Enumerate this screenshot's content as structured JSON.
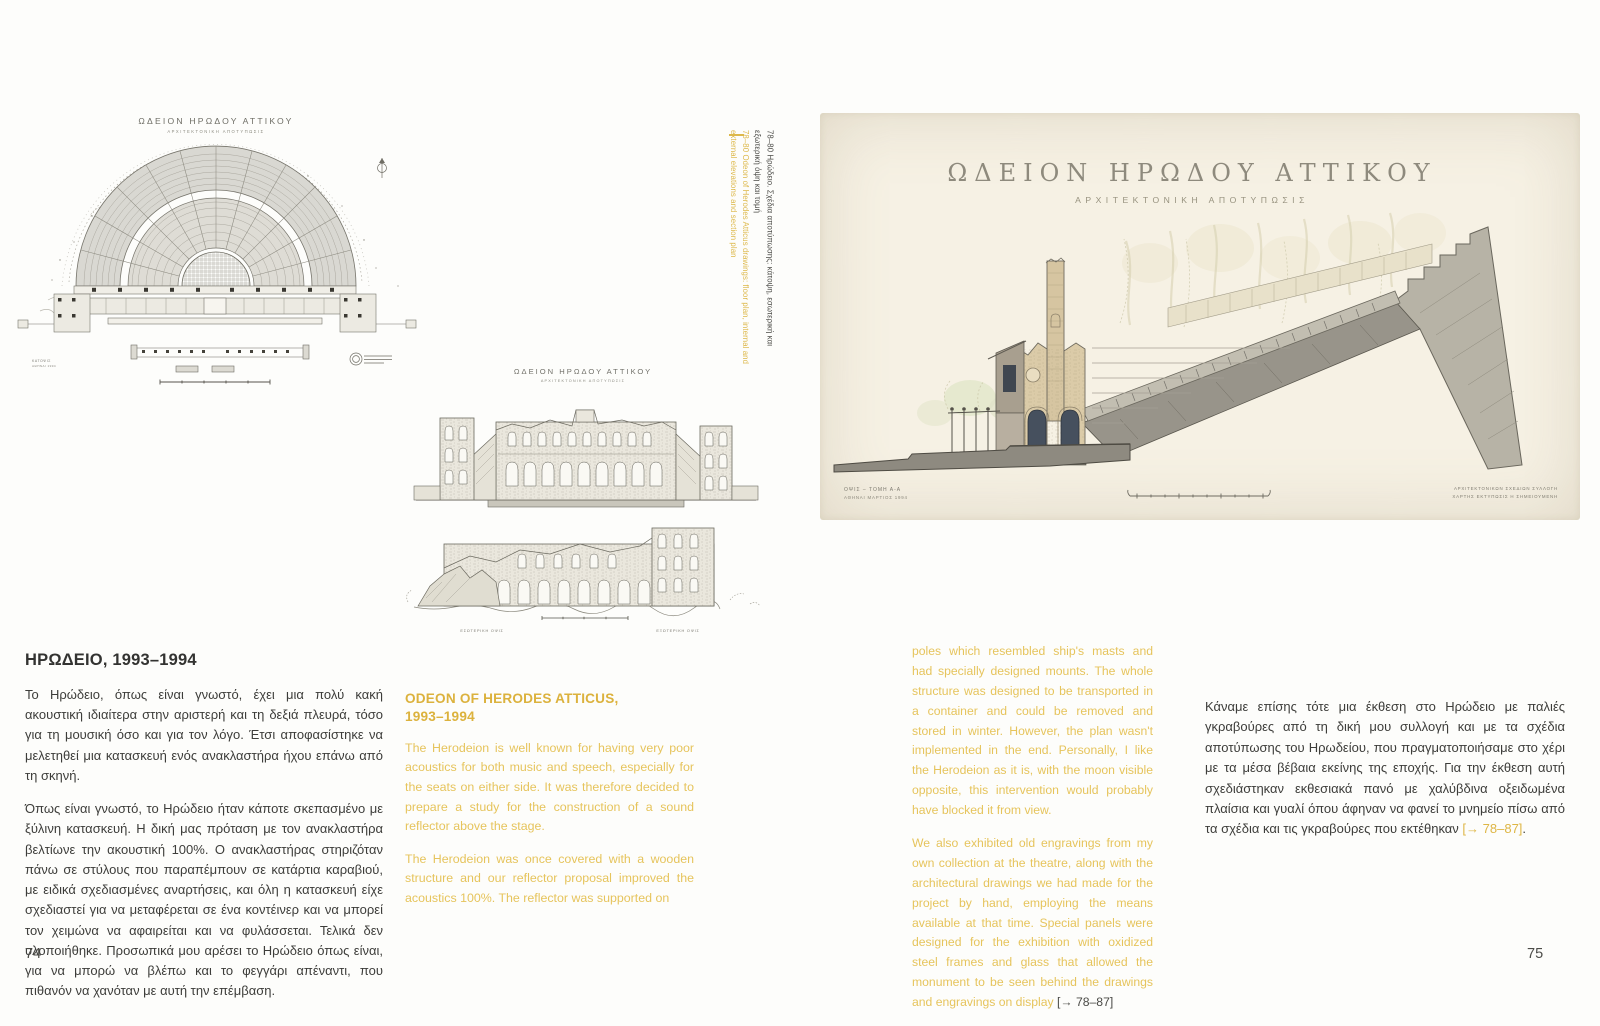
{
  "colors": {
    "accent_yellow": "#e2bd4a",
    "heading_yellow": "#dcb23d",
    "text_dark": "#3d3d3a",
    "paper_cream": "#f6f1e4"
  },
  "page_left": {
    "page_number": "74",
    "plan_drawing": {
      "title": "ΩΔΕΙΟΝ ΗΡΩΔΟΥ ΑΤΤΙΚΟΥ",
      "subtitle": "ΑΡΧΙΤΕΚΤΟΝΙΚΗ ΑΠΟΤΥΠΩΣΙΣ",
      "corner_note_1": "ΚΑΤΟΨΙΣ",
      "corner_note_2": "ΑΘΗΝΑΙ 1994"
    },
    "elevation_drawing": {
      "title": "ΩΔΕΙΟΝ ΗΡΩΔΟΥ ΑΤΤΙΚΟΥ",
      "subtitle": "ΑΡΧΙΤΕΚΤΟΝΙΚΗ ΑΠΟΤΥΠΩΣΙΣ",
      "label_left": "ΕΣΩΤΕΡΙΚΗ ΟΨΙΣ",
      "label_right": "ΕΞΩΤΕΡΙΚΗ ΟΨΙΣ"
    },
    "vertical_caption": {
      "greek": "78–80 Ηρώδειο. Σχέδια αποτύπωσης: κάτοψη, εσωτερική και εξωτερική όψη και τομή",
      "english": "78–80 Odeon of Herodes Atticus drawings: floor plan, internal and external elevations and section plan"
    },
    "greek_section": {
      "heading": "ΗΡΩΔΕΙΟ, 1993–1994",
      "paragraphs": [
        "Το Ηρώδειο, όπως είναι γνωστό, έχει μια πολύ κακή ακουστική ιδιαίτερα στην αριστερή και τη δεξιά πλευρά, τόσο για τη μουσική όσο και για τον λόγο. Έτσι αποφασίστηκε να μελετηθεί μια κατασκευή ενός ανακλαστήρα ήχου επάνω από τη σκηνή.",
        "Όπως είναι γνωστό, το Ηρώδειο ήταν κάποτε σκεπασμένο με ξύλινη κατασκευή. Η δική μας πρόταση με τον ανακλαστήρα βελτίωνε την ακουστική 100%. Ο ανακλαστήρας στηριζόταν πάνω σε στύλους που παραπέμπουν σε κατάρτια καραβιού, με ειδικά σχεδιασμένες αναρτήσεις, και όλη η κατασκευή είχε σχεδιαστεί για να μεταφέρεται σε ένα κοντέινερ και να μπορεί τον χειμώνα να αφαιρείται και να φυλάσσεται. Τελικά δεν υλοποιήθηκε. Προσωπικά μου αρέσει το Ηρώδειο όπως είναι, για να μπορώ να βλέπω και το φεγγάρι απέναντι, που πιθανόν να χανόταν με αυτή την επέμβαση."
      ]
    },
    "english_section": {
      "heading_line1": "ODEON OF HERODES ATTICUS,",
      "heading_line2": "1993–1994",
      "paragraphs": [
        "The Herodeion is well known for having very poor acoustics for both music and speech, especially for the seats on either side. It was therefore decided to prepare a study for the construction of a sound reflector above the stage.",
        "The Herodeion was once covered with a wooden structure and our reflector proposal improved the acoustics 100%. The reflector was supported on"
      ]
    }
  },
  "page_right": {
    "page_number": "75",
    "section_drawing": {
      "title": "ΩΔΕΙΟΝ ΗΡΩΔΟΥ ΑΤΤΙΚΟΥ",
      "subtitle": "ΑΡΧΙΤΕΚΤΟΝΙΚΗ ΑΠΟΤΥΠΩΣΙΣ",
      "caption_left_line1": "ΟΨΙΣ – ΤΟΜΗ Α-Α",
      "caption_left_line2": "ΑΘΗΝΑΙ ΜΑΡΤΙΟΣ 1994",
      "caption_right_line1": "ΑΡΧΙΤΕΚΤΟΝΙΚΩΝ ΣΧΕΔΙΩΝ ΣΥΛΛΟΓΗ",
      "caption_right_line2": "ΧΑΡΤΗΣ ΕΚΤΥΠΩΣΙΣ Η ΣΗΜΕΙΟΥΜΕΝΗ"
    },
    "english_column": {
      "paragraph1": "poles which resembled ship's masts and had specially designed mounts. The whole structure was designed to be transported in a container and could be removed and stored in winter. However, the plan wasn't implemented in the end. Personally, I like the Herodeion as it is, with the moon visible opposite, this intervention would probably have blocked it from view.",
      "paragraph2_main": "We also exhibited old engravings from my own collection at the theatre, along with the architectural drawings we had made for the project by hand, employing the means available at that time. Special panels were designed for the exhibition with oxidized steel frames and glass that allowed the monument to be seen behind the drawings and engravings on display ",
      "paragraph2_ref": "[→ 78–87]"
    },
    "greek_column": {
      "paragraph_main": "Κάναμε επίσης τότε μια έκθεση στο Ηρώδειο με παλιές γκραβούρες από τη δική μου συλλογή και με τα σχέδια αποτύπωσης του Ηρωδείου, που πραγματοποιήσαμε στο χέρι με τα μέσα βέβαια εκείνης της εποχής. Για την έκθεση αυτή σχεδιάστηκαν εκθεσιακά πανό με χαλύβδινα οξειδωμένα πλαίσια και γυαλί όπου άφηναν να φανεί το μνημείο πίσω από τα σχέδια και τις γκραβούρες που εκτέθηκαν ",
      "paragraph_ref": "[→ 78–87]",
      "paragraph_end": "."
    }
  }
}
